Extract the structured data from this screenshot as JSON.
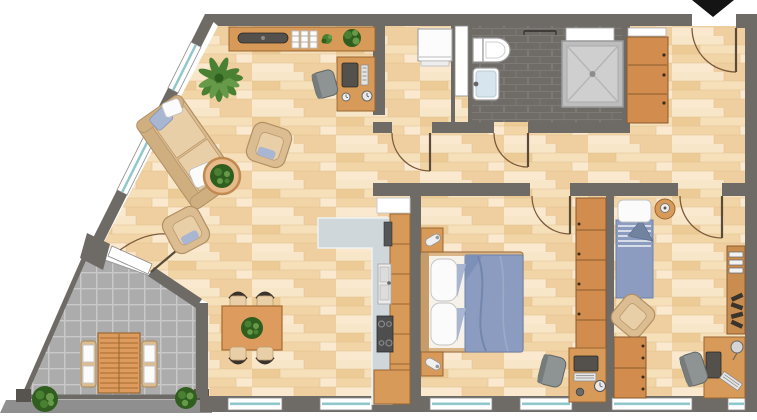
{
  "meta": {
    "type": "apartment-floor-plan",
    "canvas_width": 757,
    "canvas_height": 420,
    "visible_text": "none"
  },
  "palette": {
    "wall": "#6e6a66",
    "wallDark": "#57534f",
    "plankA": "#f7e6c8",
    "plankB": "#efcf9f",
    "plankC": "#eccb96",
    "plankD": "#f6e0ba",
    "plankE": "#f2d5a6",
    "plankF": "#fae9cf",
    "plankSeam": "#e2bd8e",
    "bathFloor": "#6f6b67",
    "bathGrout": "#7d7975",
    "terraceTile": "#acacac",
    "terraceGrout": "#c9c9c9",
    "terraceEdge": "#8f8f8f",
    "windowTeal": "#8fc7cb",
    "windowFrame": "#8a8a8a",
    "furnitureWood": "#d79a58",
    "furnitureWoodDark": "#9a6630",
    "cabinetOrange": "#d28d4e",
    "cabinetOrangeDark": "#8a5a2e",
    "sofaTan": "#dcbd92",
    "sofaTanShade": "#cfae80",
    "sofaTanDark": "#b09064",
    "cushionLight": "#e8cfa8",
    "textileBlue": "#8b9cc0",
    "textileBlueDark": "#6e82ab",
    "textileBlueLight": "#a9b6d2",
    "chairGray": "#8e9494",
    "chairGrayDark": "#5f6666",
    "applianceDark": "#54504b",
    "counterGray": "#cfd7da",
    "plantGreen": "#4a8032",
    "plantGreenDark": "#2f5e1e",
    "plantGreenLight": "#679a48",
    "doorArc": "#7a5a3a",
    "arrowBlack": "#141414",
    "sinkBlue": "#d7e5ee",
    "fixtureStroke": "#9a9a9a",
    "tableWood": "#dd9c5d",
    "chairBackDark": "#3a332c"
  },
  "rooms": [
    {
      "id": "living-dining-room",
      "floor": "wood-planks",
      "furniture": [
        "sofa",
        "coffee-table-with-plant",
        "armchair",
        "armchair",
        "floor-plant",
        "sideboard-with-tv",
        "desk-with-computer",
        "dining-table-with-plant",
        "dining-chairs-x4"
      ]
    },
    {
      "id": "open-kitchen",
      "floor": "wood-planks",
      "furniture": [
        "l-shaped-counter",
        "tall-cabinet-row",
        "fridge",
        "sink",
        "hob",
        "corner-unit",
        "wall-niche"
      ]
    },
    {
      "id": "utility-room",
      "floor": "wood-planks",
      "furniture": [
        "washing-machine",
        "white-niche"
      ]
    },
    {
      "id": "bathroom",
      "floor": "dark-tiles",
      "furniture": [
        "toilet",
        "washbasin",
        "towel-rail",
        "shower",
        "white-shelf"
      ]
    },
    {
      "id": "hallway",
      "floor": "wood-planks",
      "furniture": []
    },
    {
      "id": "entrance-hall",
      "floor": "wood-planks",
      "furniture": [
        "wardrobe-cabinet",
        "white-shelf"
      ]
    },
    {
      "id": "bedroom-master",
      "floor": "wood-planks",
      "furniture": [
        "double-bed",
        "nightstand-with-lamp",
        "nightstand-with-lamp",
        "wardrobe",
        "desk-with-computer",
        "desk-chair"
      ]
    },
    {
      "id": "bedroom-second",
      "floor": "wood-planks",
      "furniture": [
        "single-bed",
        "round-bedside-table-with-lamp",
        "armchair",
        "chest-of-drawers",
        "bookshelf",
        "desk-with-computer",
        "desk-chair"
      ]
    },
    {
      "id": "terrace",
      "floor": "stone-tiles",
      "furniture": [
        "slatted-garden-table",
        "garden-chair",
        "garden-chair",
        "bush",
        "bush"
      ]
    }
  ],
  "openings": {
    "entrance_door": "top-right-with-swing-arc",
    "interior_doors": [
      "utility-room",
      "bathroom",
      "bedroom-master",
      "bedroom-second",
      "terrace"
    ],
    "windows": [
      "diagonal-facade-x2",
      "bottom-facade-x6"
    ]
  },
  "indicators": {
    "entrance_arrow": "black-arrow-pointing-down-at-entrance-door"
  }
}
